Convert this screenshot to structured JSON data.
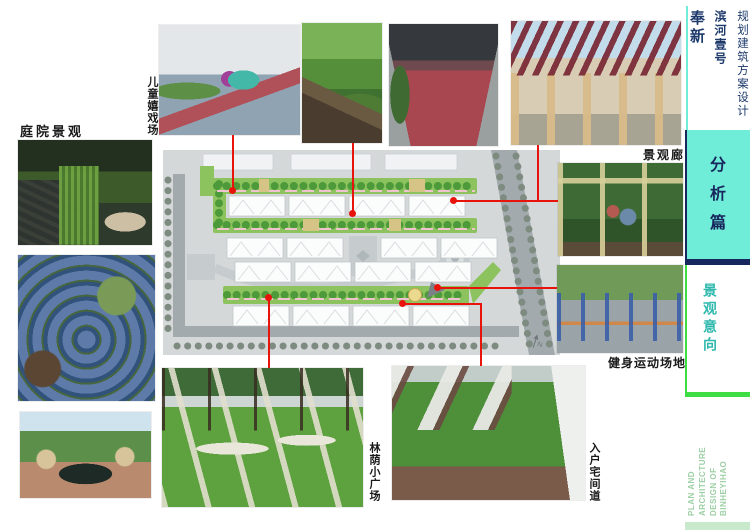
{
  "header": {
    "project_type": "规划建筑方案设计",
    "project_name": "滨河壹号",
    "location": "奉新"
  },
  "sidebar": {
    "section_badge": "分析篇",
    "section_title": "景观意向",
    "footer": {
      "line1": "PLAN AND ARCHITECTURE",
      "line2": "DESIGN OF",
      "line3": "BINHEYIHAO"
    }
  },
  "labels": {
    "courtyard": "庭院景观",
    "children_playground": "儿童嬉戏场",
    "landscape_corridor": "景观廊",
    "fitness_area": "健身运动场地",
    "shaded_plaza": "林荫小广场",
    "entry_path": "入户宅间道"
  },
  "plan": {
    "north_mark": "N"
  },
  "colors": {
    "accent-cyan": "#6FEDD8",
    "navy": "#17265C",
    "title-navy": "#1D3A6B",
    "accent-green": "#3FDD44",
    "teal-text": "#2FB8AD",
    "light-green-text": "#9DCFA4",
    "mint-bar": "#C9E9CD",
    "callout-red": "#E8140C",
    "label-ink": "#1A1A1A"
  }
}
